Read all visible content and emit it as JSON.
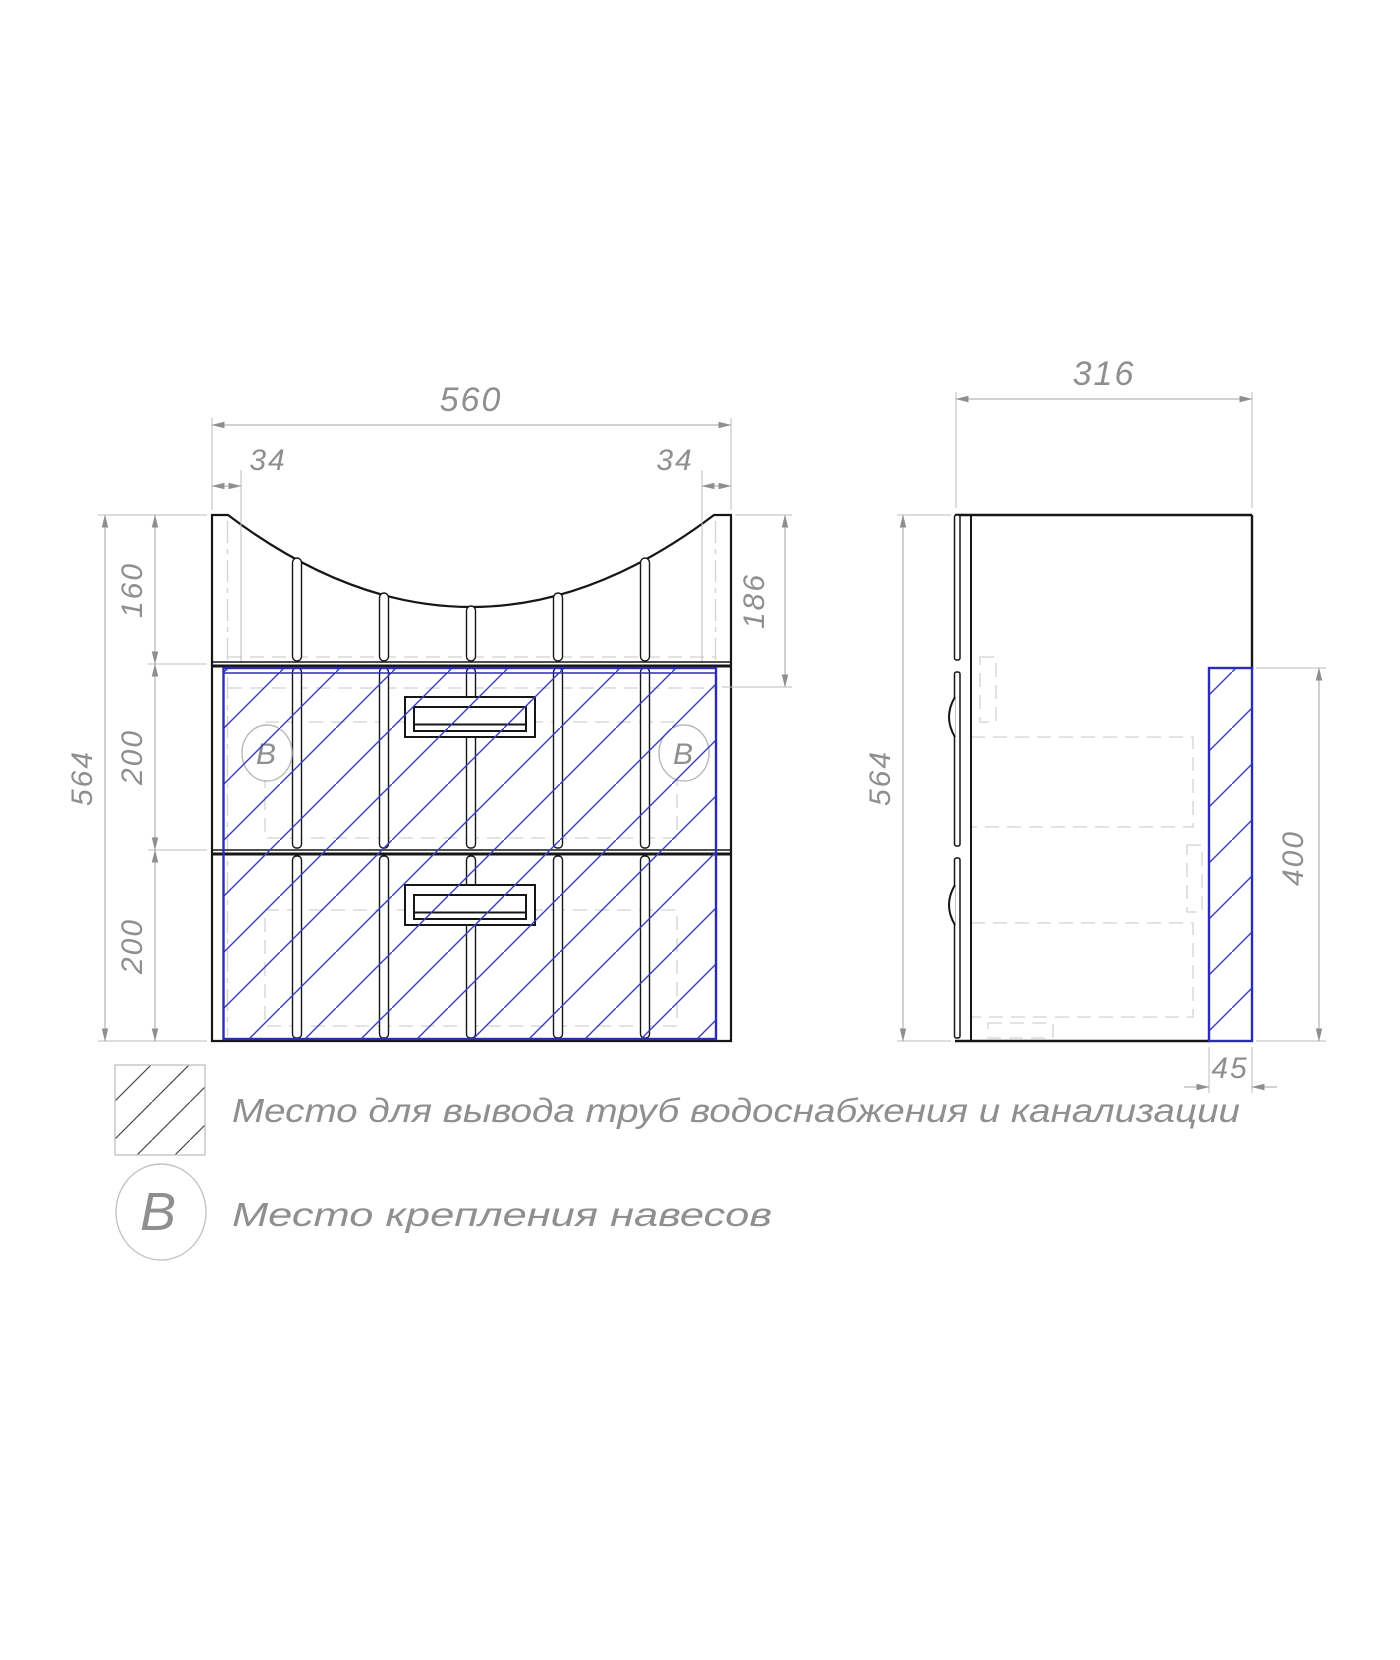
{
  "front_view": {
    "dims": {
      "width": "560",
      "offset_left": "34",
      "offset_right": "34",
      "apron_height": "160",
      "drawer_top_height": "200",
      "drawer_bottom_height": "200",
      "total_height": "564",
      "recess_depth": "186"
    },
    "mount_symbol": "B"
  },
  "side_view": {
    "dims": {
      "depth": "316",
      "total_height": "564",
      "pipe_zone_height": "400",
      "pipe_zone_depth": "45"
    }
  },
  "legend": {
    "pipe_zone_label": "Место для вывода труб водоснабжения и канализации",
    "mount_symbol": "B",
    "mount_label": "Место крепления навесов"
  },
  "colors": {
    "pipe_zone": "#2b2bb4",
    "line": "#161616",
    "dim_text": "#8f8f8f"
  }
}
